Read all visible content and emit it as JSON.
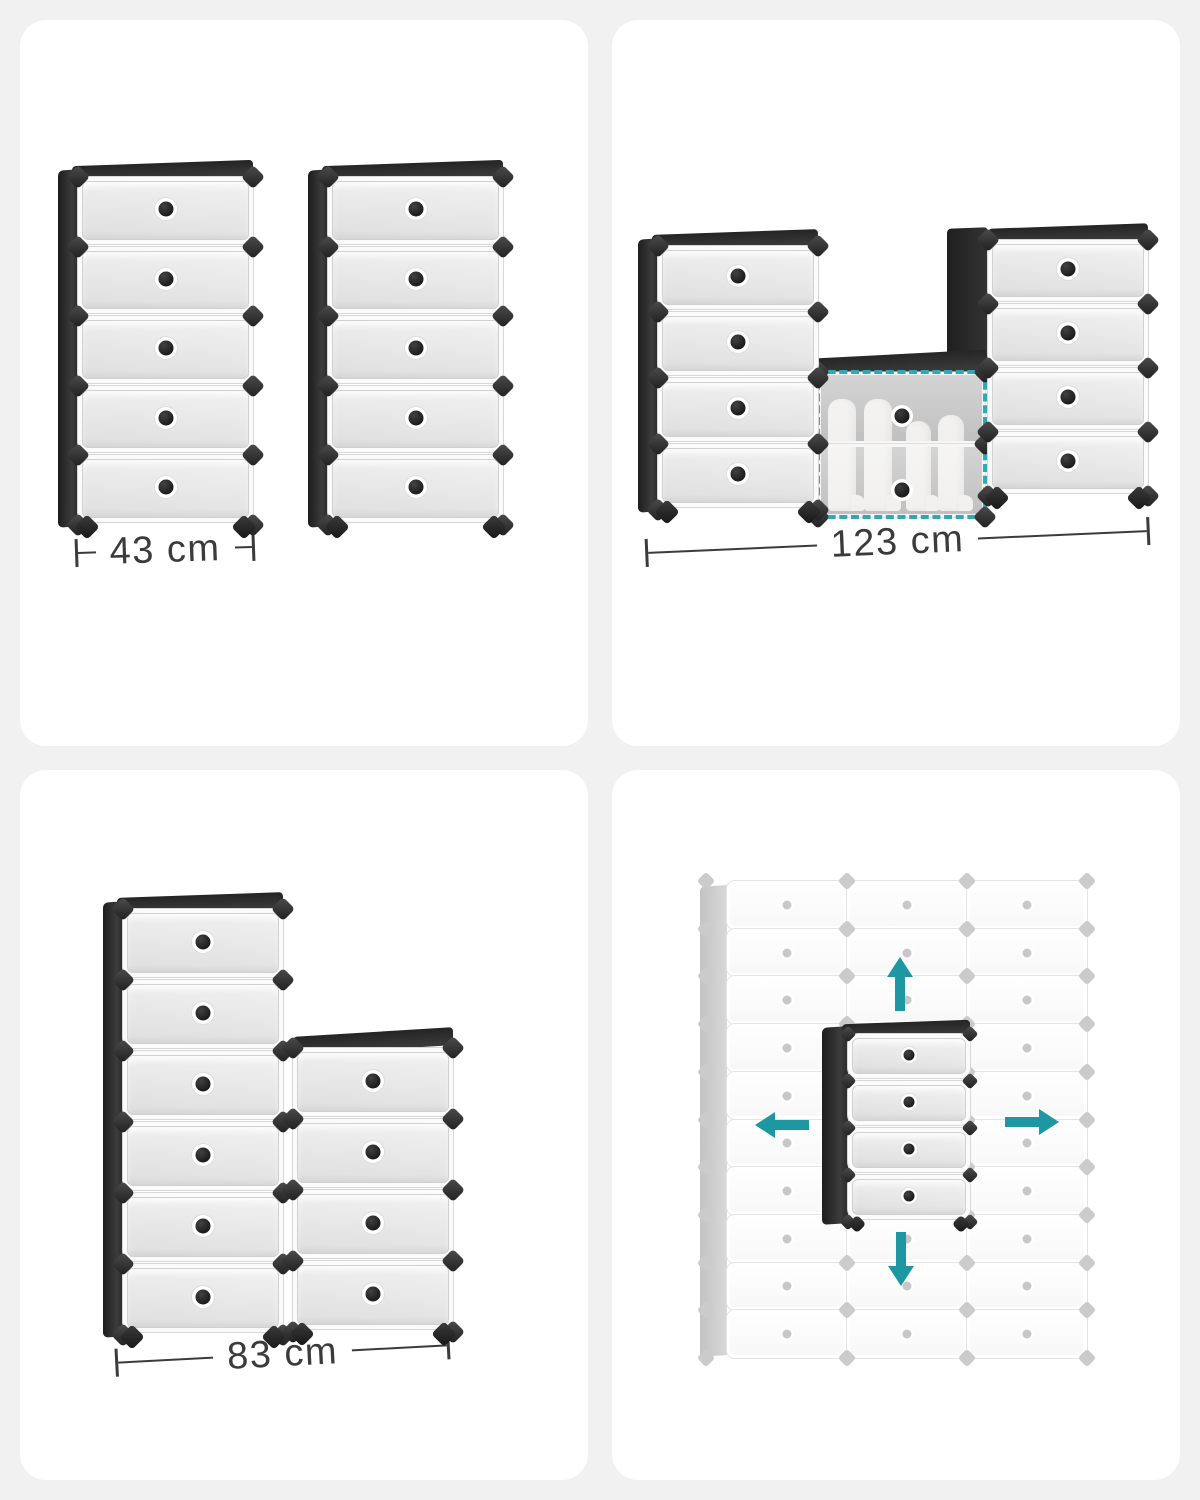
{
  "image_type": "product-infographic-collage",
  "product": "interlocking cube shoe storage organizer",
  "colors": {
    "teal": "#1e97a2",
    "highlight_dash": "#31a9b4",
    "frame_black": "#2c2c2c",
    "drawer_grey": "#e6e6e6",
    "ghost_grey": "#cbcbcb",
    "dim_text": "#3b3b3b",
    "card_bg": "#ffffff",
    "page_bg": "#f1f1f1"
  },
  "panels": {
    "two_towers": {
      "description": "two 5-tier slim shoe towers side by side",
      "dimension_label": "43 cm",
      "units": [
        {
          "drawers": 5
        },
        {
          "drawers": 5
        }
      ]
    },
    "u_shape": {
      "description": "U-shaped combination with open middle cube holding boots",
      "dimension_label": "123 cm",
      "left_unit_drawers": 4,
      "right_unit_drawers": 4,
      "middle_open_door_rows": 2,
      "middle_contents": "boots",
      "highlight_style": "teal-dashed-outline"
    },
    "l_shape": {
      "description": "stepped L-shaped combination",
      "dimension_label": "83 cm",
      "units": [
        {
          "drawers": 6
        },
        {
          "drawers": 4
        }
      ]
    },
    "expansion": {
      "description": "black 4-tier unit expandable in all directions within ghost grid",
      "ghost_grid": {
        "columns": 3,
        "rows": 10
      },
      "center_unit_drawers": 4,
      "arrows": [
        "up",
        "left",
        "right",
        "down"
      ]
    }
  }
}
